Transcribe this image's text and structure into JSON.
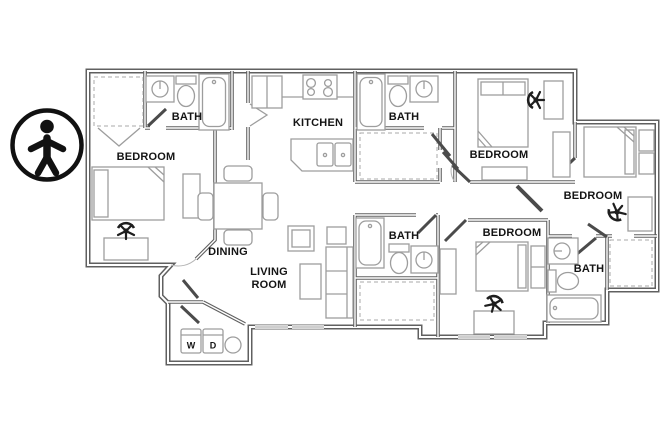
{
  "image": {
    "type": "apartment-floor-plan",
    "background": "#ffffff"
  },
  "badge": {
    "icon": "accessibility-icon",
    "color": "#111111"
  },
  "floor_plan": {
    "colors": {
      "wall": "#606060",
      "furniture": "#9d9d9d",
      "door": "#4b4b4b",
      "label": "#141414",
      "closet_dashed": "#aaaaaa"
    },
    "rooms": {
      "bedrooms": [
        "BEDROOM",
        "BEDROOM",
        "BEDROOM",
        "BEDROOM"
      ],
      "baths": [
        "BATH",
        "BATH",
        "BATH",
        "BATH"
      ],
      "kitchen": "KITCHEN",
      "dining": "DINING",
      "living": {
        "line1": "LIVING",
        "line2": "ROOM"
      },
      "laundry": {
        "washer": "W",
        "dryer": "D"
      }
    }
  }
}
